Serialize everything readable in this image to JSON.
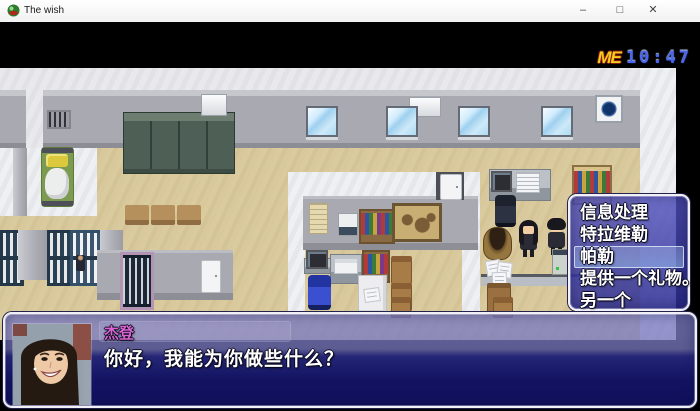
{
  "window": {
    "title": "The wish",
    "icon": "rpg-maker-app-icon",
    "controls": {
      "minimize": "–",
      "maximize": "□",
      "close": "✕"
    }
  },
  "hud": {
    "logo": "ME",
    "time": "10:47"
  },
  "choice_menu": {
    "selected_index": 2,
    "items": [
      {
        "label": "信息处理",
        "selected": false
      },
      {
        "label": "特拉维勒",
        "selected": false
      },
      {
        "label": "帕勒",
        "selected": true
      },
      {
        "label": "提供一个礼物。",
        "selected": false
      },
      {
        "label": "另一个",
        "selected": false
      }
    ]
  },
  "dialogue": {
    "speaker": "杰登",
    "text": "你好，我能为你做些什么？",
    "portrait": "woman-photo-portrait"
  },
  "colors": {
    "ui_window_blue": "#3c3caa",
    "selection_highlight": "#9db8e6",
    "speaker_name": "#d964d0",
    "hud_logo_yellow": "#f2cf1c",
    "hud_time_blue": "#4a66ee",
    "floor_tan": "#d8c89b",
    "wall_gray": "#a9a9b1"
  }
}
